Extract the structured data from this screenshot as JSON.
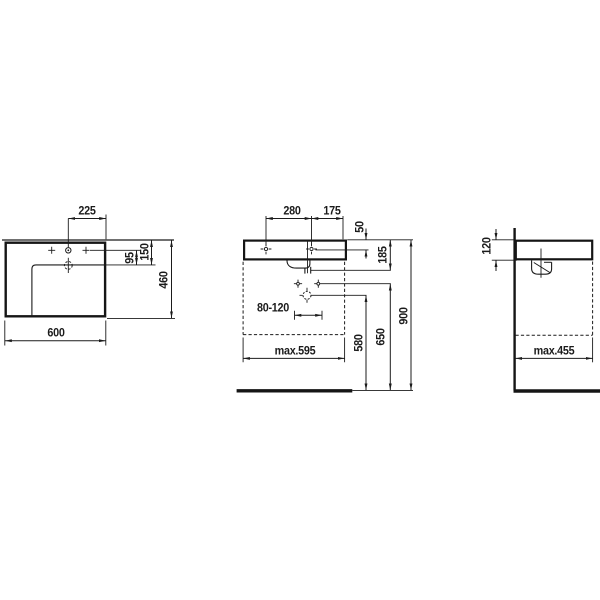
{
  "drawing": {
    "type": "washbasin technical dimension drawing",
    "ink_color": "#1b1b1b",
    "background": "#ffffff",
    "views": {
      "plan": {
        "title": "plan-view",
        "dims": {
          "total_width": "600",
          "tap_to_right_edge": "225",
          "tap_to_bowl_edge": "95",
          "back_to_bowl_edge": "150",
          "total_depth": "460"
        }
      },
      "front": {
        "title": "front-view",
        "dims": {
          "fixing_hole_spacing": "280",
          "fixing_hole_to_edge": "175",
          "rim_to_fixing_holes": "50",
          "rim_to_outlet": "185",
          "outlet_lateral_range": "80-120",
          "max_clearance_width": "max.595",
          "outlet_height": "580",
          "fixing_bolt_height": "650",
          "rim_height": "900"
        }
      },
      "side": {
        "title": "side-view",
        "dims": {
          "rim_thickness": "120",
          "max_clearance_depth": "max.455"
        }
      }
    }
  }
}
